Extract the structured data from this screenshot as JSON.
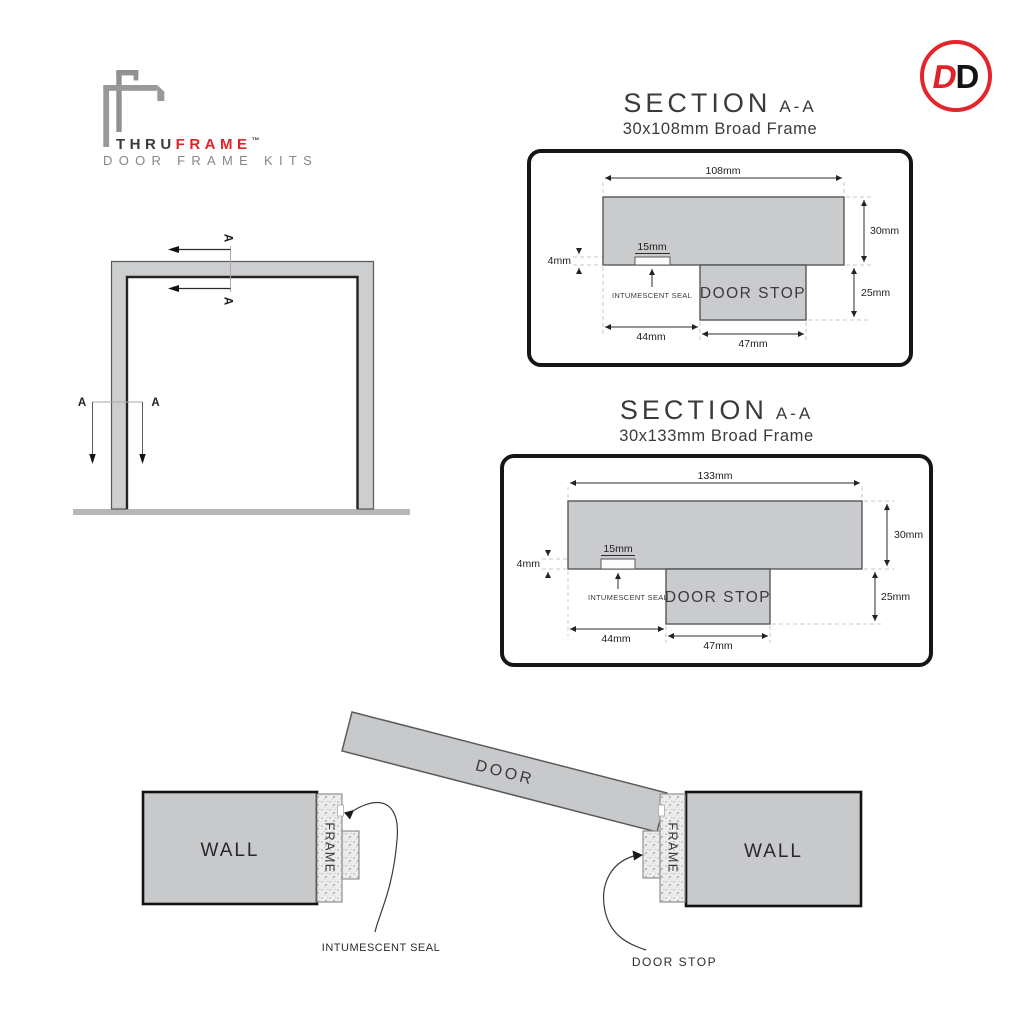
{
  "brand": {
    "name_part1": "THRU",
    "name_part2": "FRAME",
    "trademark": "™",
    "tagline": "DOOR FRAME KITS"
  },
  "badge": {
    "letter1": "D",
    "letter2": "D"
  },
  "elevation": {
    "section_marker": "A"
  },
  "sections": [
    {
      "title": "SECTION",
      "cut_label": "A-A",
      "subtitle": "30x108mm Broad Frame",
      "overall_width": "108mm",
      "frame_depth": "30mm",
      "stop_depth": "25mm",
      "seal_depth": "4mm",
      "seal_width": "15mm",
      "rebate_offset": "44mm",
      "stop_width": "47mm",
      "stop_label": "DOOR STOP",
      "seal_label": "INTUMESCENT SEAL"
    },
    {
      "title": "SECTION",
      "cut_label": "A-A",
      "subtitle": "30x133mm Broad Frame",
      "overall_width": "133mm",
      "frame_depth": "30mm",
      "stop_depth": "25mm",
      "seal_depth": "4mm",
      "seal_width": "15mm",
      "rebate_offset": "44mm",
      "stop_width": "47mm",
      "stop_label": "DOOR STOP",
      "seal_label": "INTUMESCENT SEAL"
    }
  ],
  "detail_view": {
    "wall_label": "WALL",
    "frame_label": "FRAME",
    "door_label": "DOOR",
    "seal_label": "INTUMESCENT SEAL",
    "stop_label": "DOOR STOP"
  },
  "colors": {
    "accent_red": "#e2232a",
    "fill_gray": "#c9cbcd",
    "line_dark": "#2b2b2b",
    "logo_gray": "#97999b"
  }
}
